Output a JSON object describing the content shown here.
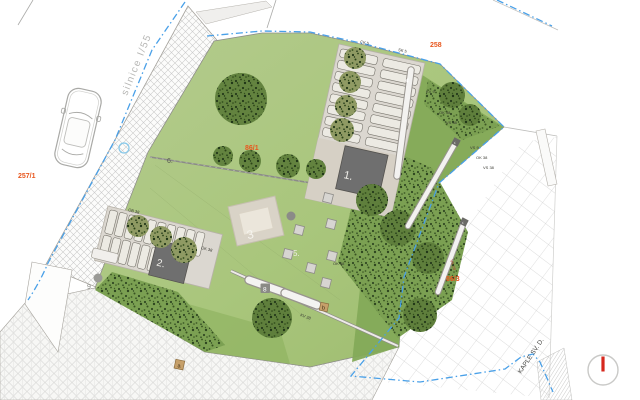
{
  "plan": {
    "road_label": "silnice I/55",
    "chapel_label": "KAPLE SV. D.",
    "parcel_labels": {
      "p258": "258",
      "p257_1": "257/1",
      "p86_1": "86/1",
      "p86_3": "86/3"
    },
    "area_labels": {
      "building1": "1.",
      "building2": "2.",
      "terrace": "3",
      "wall": "4",
      "stones": "5.",
      "fence": "6.",
      "bench": "8",
      "point9": "9."
    },
    "small_markers": {
      "a": "a",
      "b": "b"
    },
    "wall_tag": "VS 28",
    "plant_tags": [
      {
        "text": "CK 5"
      },
      {
        "text": "SK 5"
      },
      {
        "text": "KV 9"
      },
      {
        "text": "OK 38"
      },
      {
        "text": "VS 38"
      },
      {
        "text": "VS 9"
      },
      {
        "text": "OK 38"
      },
      {
        "text": "VS 38"
      },
      {
        "text": "OB 38"
      },
      {
        "text": "OK 38"
      },
      {
        "text": "KV 38"
      },
      {
        "text": "OK 38"
      }
    ],
    "colors": {
      "lawn": "#a9c67c",
      "lawn_dark": "#84aa58",
      "pavement": "#dbd7d0",
      "building": "#6f6f6f",
      "boundary_blue": "#49a0e8",
      "parcel_orange": "#e8571e",
      "north_red": "#d6281e"
    }
  }
}
